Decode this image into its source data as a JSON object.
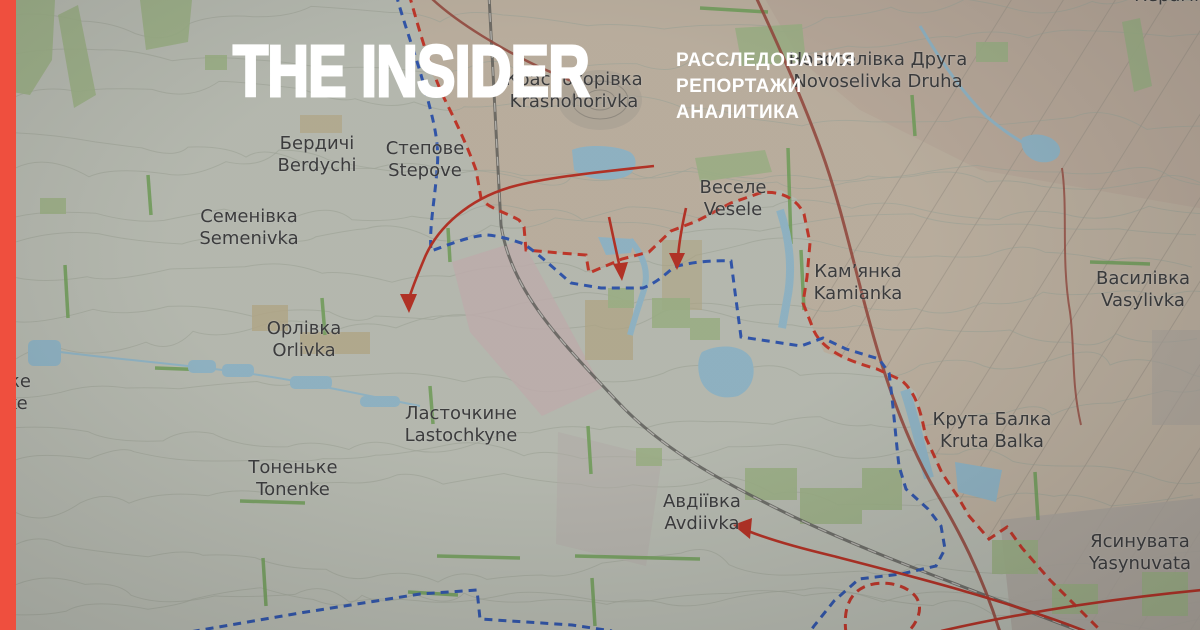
{
  "brand": {
    "logo_text": "THE INSIDER",
    "tagline_lines": [
      "РАССЛЕДОВАНИЯ",
      "РЕПОРТАЖИ",
      "АНАЛИТИКА"
    ]
  },
  "colors": {
    "brand_red": "#EF4F3E",
    "front_line_russian": "#E8402F",
    "front_line_ukrainian": "#3A66CC",
    "attack_arrow": "#D93A2A",
    "water": "#AED9EC"
  },
  "map": {
    "places": [
      {
        "uk": "Бердичі",
        "en": "Berdychi",
        "x": 317,
        "y": 133
      },
      {
        "uk": "Степове",
        "en": "Stepove",
        "x": 425,
        "y": 138
      },
      {
        "uk": "Семенівка",
        "en": "Semenivka",
        "x": 249,
        "y": 206
      },
      {
        "uk": "Новоселівка Друга",
        "en": "Novoselivka Druha",
        "x": 878,
        "y": 49
      },
      {
        "uk": "Красногорівка",
        "en": "Krasnohorivka",
        "x": 574,
        "y": 69
      },
      {
        "uk": "Веселе",
        "en": "Vesele",
        "x": 733,
        "y": 177
      },
      {
        "uk": "Кам’янка",
        "en": "Kamianka",
        "x": 858,
        "y": 261
      },
      {
        "uk": "Василівка",
        "en": "Vasylivka",
        "x": 1143,
        "y": 268
      },
      {
        "uk": "Орлівка",
        "en": "Orlivka",
        "x": 304,
        "y": 318
      },
      {
        "uk": "Ласточкине",
        "en": "Lastochkyne",
        "x": 461,
        "y": 403
      },
      {
        "uk": "Тоненьке",
        "en": "Tonenke",
        "x": 293,
        "y": 457
      },
      {
        "uk": "Крута Балка",
        "en": "Kruta Balka",
        "x": 992,
        "y": 409
      },
      {
        "uk": "Авдіївка",
        "en": "Avdiivka",
        "x": 702,
        "y": 491
      },
      {
        "uk": "Ясинувата",
        "en": "Yasynuvata",
        "x": 1140,
        "y": 531
      },
      {
        "uk": "Уманське",
        "en": "Umanske",
        "x": -14,
        "y": 371
      },
      {
        "uk": "Керамік",
        "en": "",
        "x": 1172,
        "y": -15
      }
    ]
  }
}
